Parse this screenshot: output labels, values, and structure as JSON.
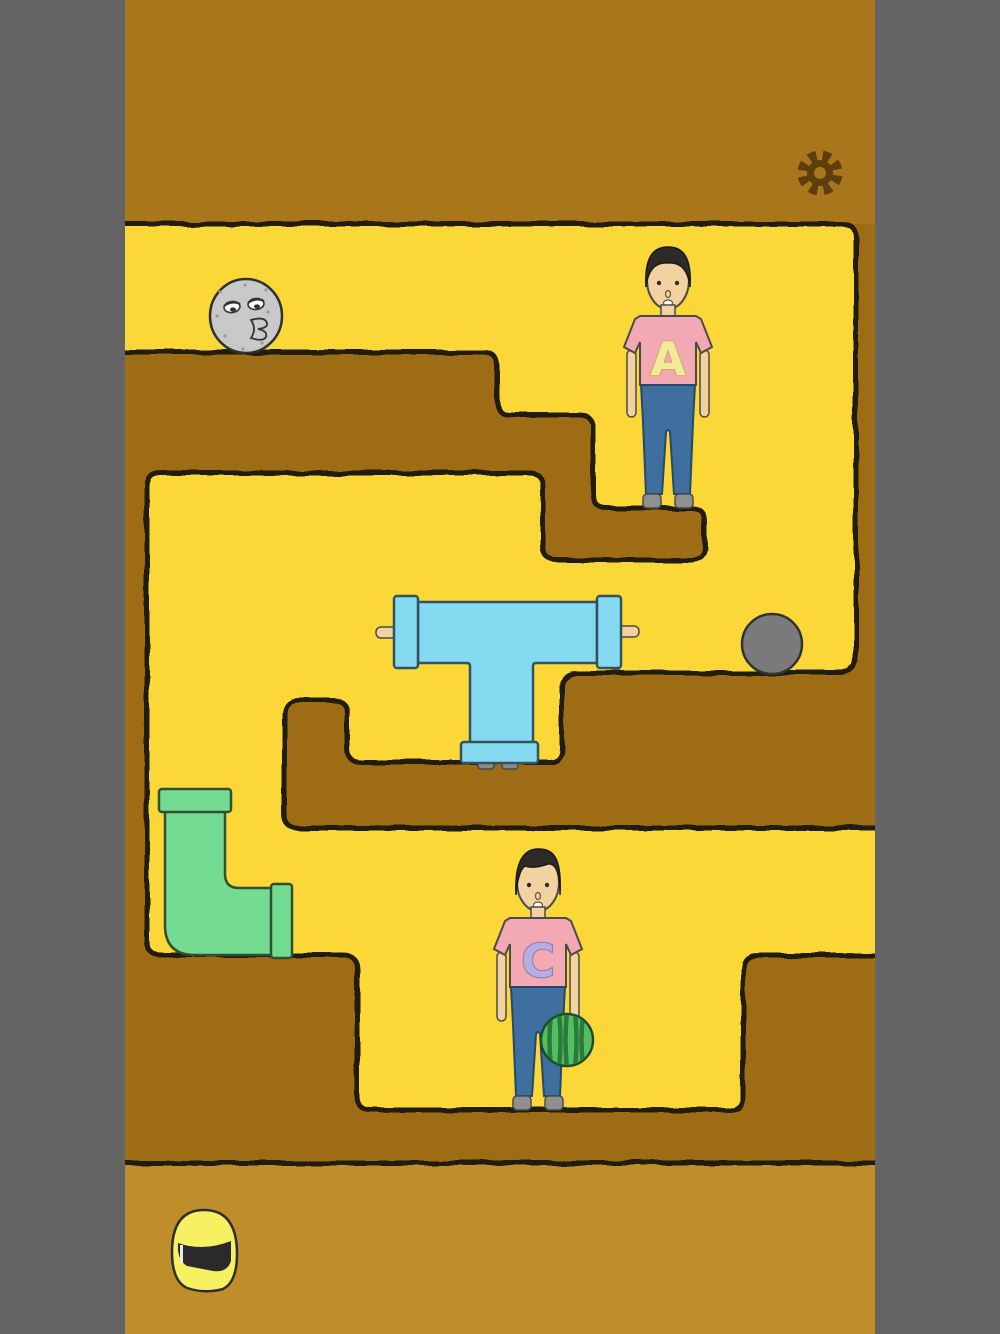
{
  "scene": {
    "type": "puzzle-game-level",
    "environment": "underground-dirt-maze",
    "bands": {
      "top": "dirt",
      "middle": "maze-with-yellow-tunnels",
      "bottom": "open-ground"
    }
  },
  "hud": {
    "settings_button": {
      "icon": "gear-icon",
      "position": "top-right"
    }
  },
  "characters": [
    {
      "name": "character-a",
      "shirt_letter": "A",
      "shirt_color": "#f2a9b3",
      "letter_color": "#f3e89c",
      "pants_color": "#3f6f9f",
      "hair_color": "#2d2a27",
      "location": "upper-right-platform"
    },
    {
      "name": "character-c",
      "shirt_letter": "C",
      "shirt_color": "#f2a9b3",
      "letter_color": "#b6aedd",
      "pants_color": "#3f6f9f",
      "hair_color": "#2d2a27",
      "holding": "watermelon",
      "location": "lower-pit"
    }
  ],
  "objects": [
    {
      "name": "moon-face",
      "desc": "gray sleepy moon rock",
      "color": "#c9c9c9",
      "location": "top-corridor-left"
    },
    {
      "name": "t-pipe",
      "desc": "blue T shaped pipe with flanges and pegs",
      "color": "#85daf2",
      "location": "middle-corridor"
    },
    {
      "name": "stone-ball",
      "desc": "gray round boulder",
      "color": "#7a7a7a",
      "location": "middle-right-ledge"
    },
    {
      "name": "elbow-pipe",
      "desc": "green L shaped pipe",
      "color": "#74dc92",
      "location": "left-channel"
    },
    {
      "name": "watermelon",
      "desc": "striped watermelon held by character C",
      "color": "#54bd63"
    },
    {
      "name": "helmet",
      "desc": "yellow full-face helmet with dark visor",
      "color": "#f7f062",
      "location": "bottom-ground"
    }
  ],
  "colors": {
    "frame": "#646464",
    "dirt_top": "#aa761c",
    "dirt_maze": "#9e6c14",
    "ground_bottom": "#c08d2b",
    "tunnel_yellow": "#fbd737",
    "outline": "#241c08",
    "gear": "#5d3e0d",
    "skin": "#f2d2a0"
  }
}
